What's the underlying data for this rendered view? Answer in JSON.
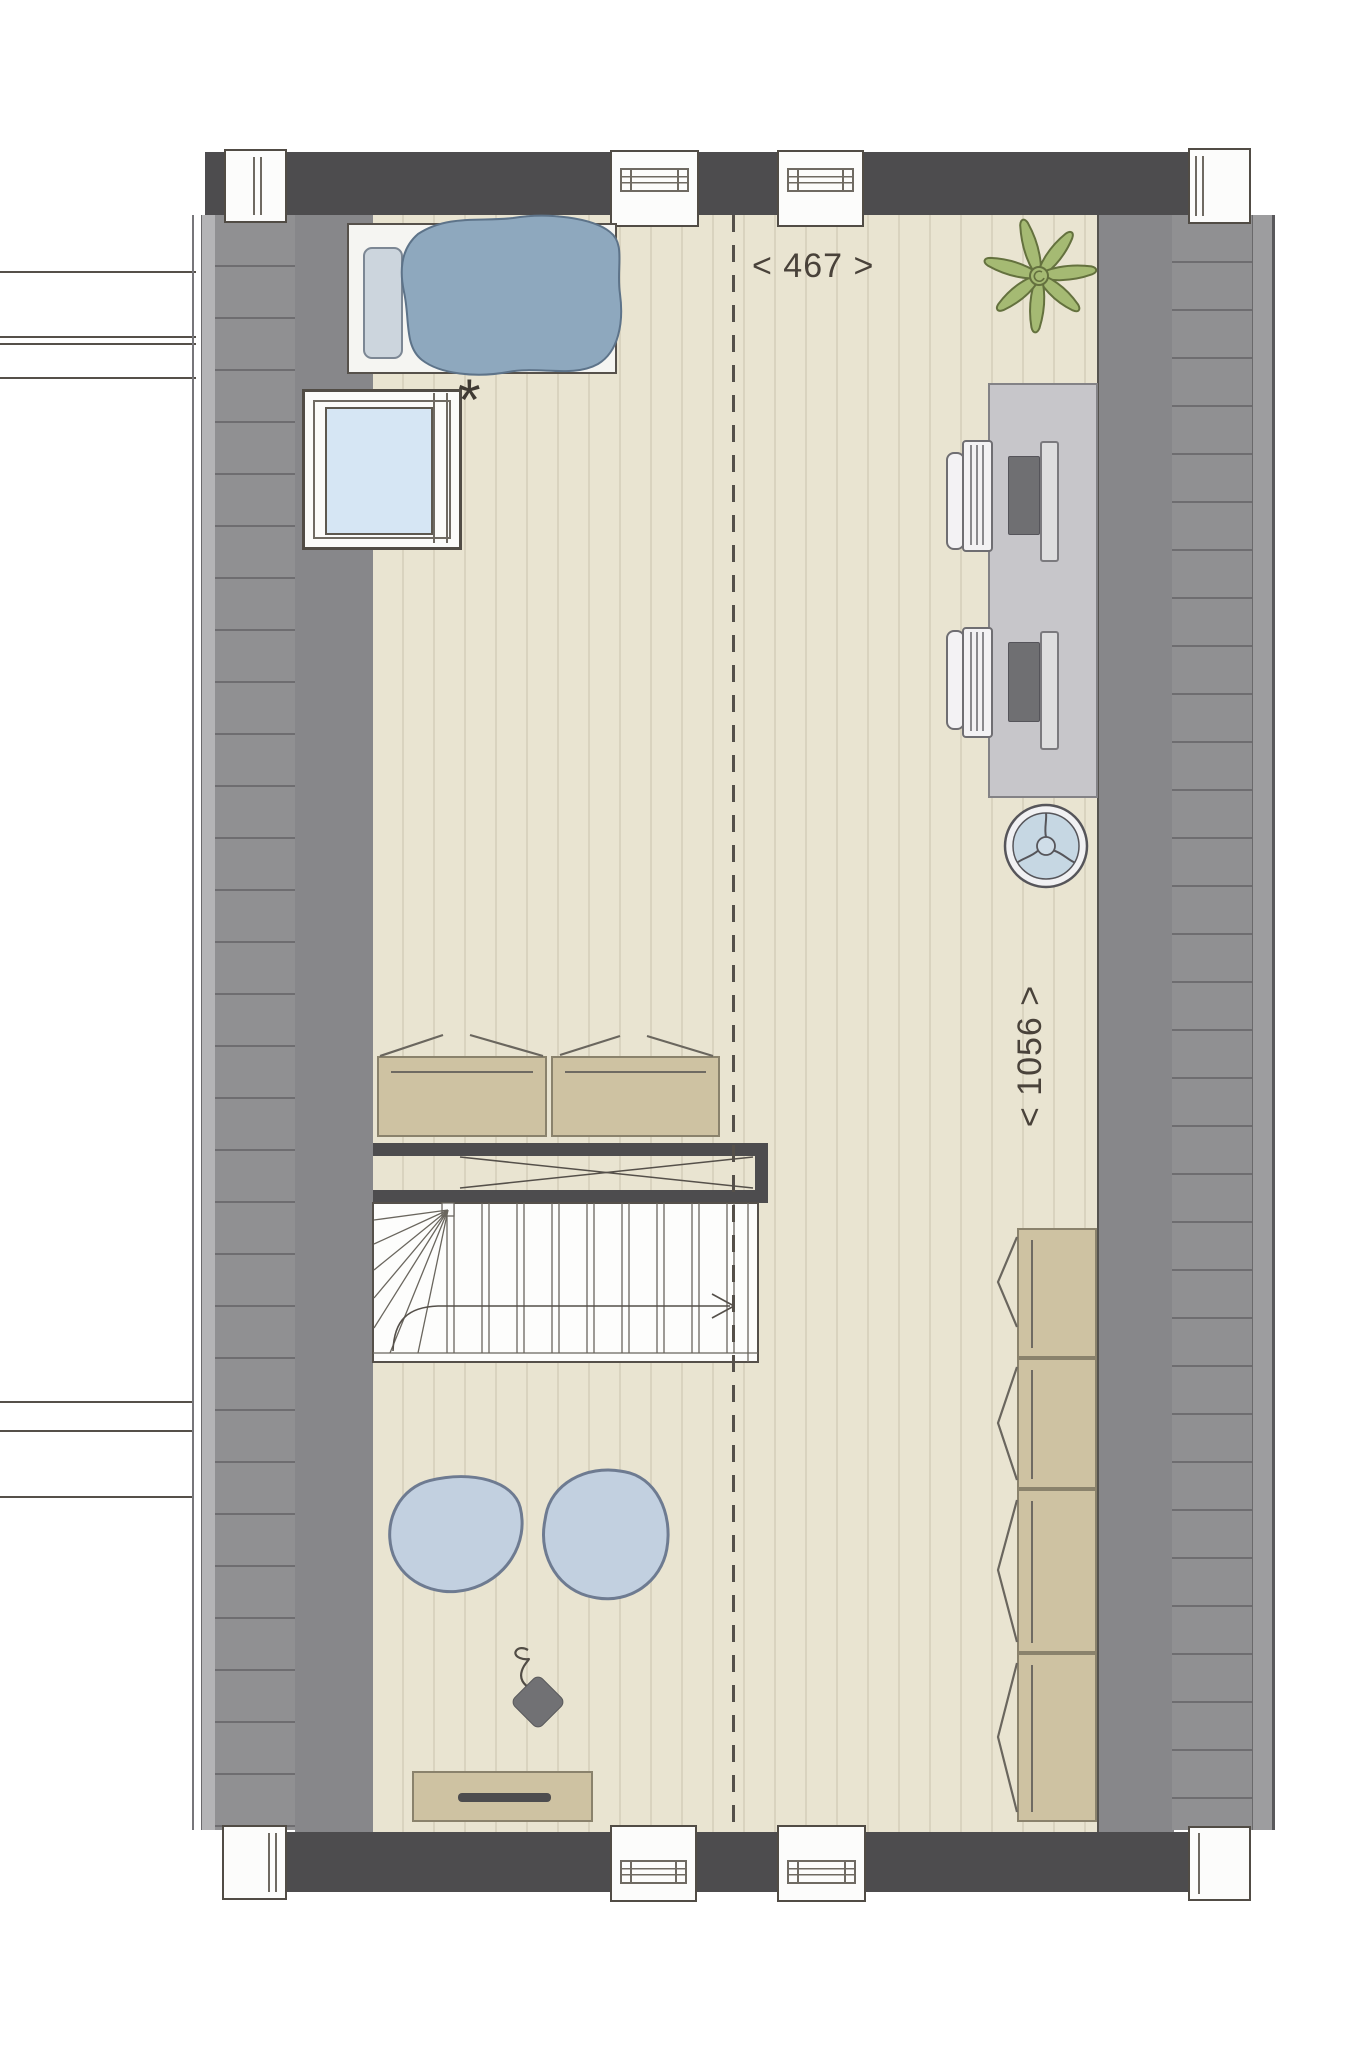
{
  "labels": {
    "width_dimension": "< 467 >",
    "depth_dimension": "< 1056 >",
    "skylight_marker": "*"
  },
  "colors": {
    "wall_dark": "#4d4c4e",
    "roof_solid": "#87878a",
    "roof_hatch": "#909092",
    "floor": "#e9e4d1",
    "floor_line": "#d9d3bf",
    "wood": "#cec2a2",
    "blue_fabric": "#8ea8be",
    "light_blue": "#c2d0e0",
    "glass": "#d6e6f4",
    "plant_green": "#a5ba73",
    "desk_gray": "#c7c6ca",
    "line_dark": "#55504a"
  },
  "objects": [
    "bed",
    "duvet",
    "pillow",
    "roof-window",
    "plant",
    "desk",
    "desk-chair",
    "monitor",
    "keyboard",
    "ceiling-fan",
    "storage-bench",
    "staircase",
    "stair-railing",
    "wardrobe",
    "floor-cushion",
    "pendant-cord",
    "sideboard",
    "dormer-window",
    "chimney-block",
    "roof-slope",
    "ridge-line"
  ]
}
